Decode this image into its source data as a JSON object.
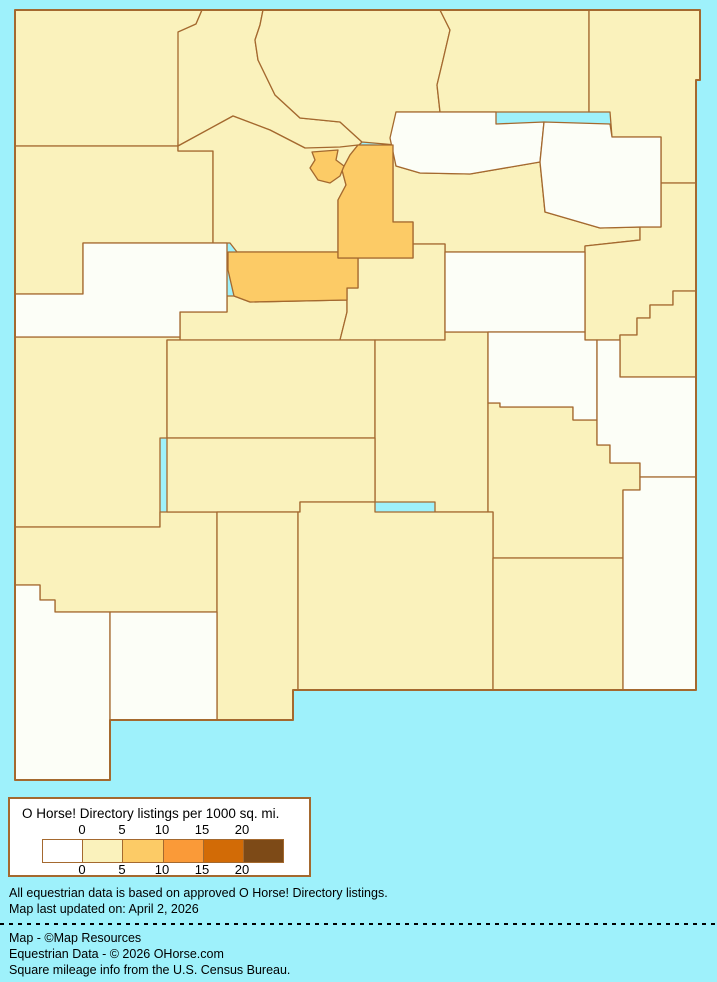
{
  "page": {
    "background_color": "#9EF1FB"
  },
  "map": {
    "description": "New Mexico county choropleth",
    "border_color": "#A4692F",
    "bucket_colors": {
      "0": "#FCFEF7",
      "0-5": "#FAF2BC",
      "5-10": "#FCCB66"
    },
    "state_outline": "15,10 700,10 700,80 696,80 696,690 293,690 293,720 110,720 110,780 15,780",
    "counties": [
      {
        "id": "san-juan",
        "bucket": "0-5",
        "points": "15,10 202,10 196,24 180,32 178,146 15,146"
      },
      {
        "id": "rio-arriba",
        "bucket": "0-5",
        "points": "202,10 263,10 260,25 255,40 258,60 275,95 300,118 340,122 362,142 356,148 338,150 312,152 305,148 270,130 233,116 178,146 178,32 196,24"
      },
      {
        "id": "taos",
        "bucket": "0-5",
        "points": "263,10 440,10 450,30 443,60 437,85 440,112 396,112 396,145 362,142 340,122 300,118 275,95 258,60 255,40 260,25"
      },
      {
        "id": "colfax",
        "bucket": "0-5",
        "points": "440,10 589,10 589,112 440,112 437,85 443,60 450,30"
      },
      {
        "id": "union",
        "bucket": "0-5",
        "points": "589,10 700,10 700,80 696,80 696,183 661,183 661,137 612,137 610,112 589,112"
      },
      {
        "id": "mckinley",
        "bucket": "0-5",
        "points": "15,146 178,146 178,151 213,151 213,243 83,243 83,294 15,294"
      },
      {
        "id": "sandoval",
        "bucket": "0-5",
        "points": "178,146 233,116 270,130 305,148 340,147 358,145 350,155 342,170 346,185 338,200 338,252 237,252 230,243 213,243 213,151 178,151"
      },
      {
        "id": "san-miguel",
        "bucket": "0-5",
        "points": "393,145 396,166 420,173 470,174 540,162 545,212 600,228 640,227 640,240 585,246 585,252 445,252 445,244 413,244 413,222 393,222"
      },
      {
        "id": "quay",
        "bucket": "0-5",
        "points": "585,246 640,240 640,227 661,227 661,183 696,183 696,291 673,291 673,305 650,305 650,318 637,318 637,335 620,335 620,340 585,340"
      },
      {
        "id": "curry",
        "bucket": "0-5",
        "points": "620,335 637,335 637,318 650,318 650,305 673,305 673,291 696,291 696,377 620,377"
      },
      {
        "id": "valencia",
        "bucket": "0-5",
        "points": "227,312 227,296 234,296 250,302 347,300 347,312 340,340 180,340 180,312"
      },
      {
        "id": "torrance",
        "bucket": "0-5",
        "points": "358,258 413,258 413,244 445,244 445,340 340,340 347,312 347,300 347,288 358,288"
      },
      {
        "id": "catron",
        "bucket": "0-5",
        "points": "15,337 180,337 180,340 167,340 167,438 160,438 160,527 15,527"
      },
      {
        "id": "socorro",
        "bucket": "0-5",
        "points": "167,340 375,340 375,438 167,438"
      },
      {
        "id": "lincoln",
        "bucket": "0-5",
        "points": "375,340 445,340 445,332 488,332 488,512 435,512 435,502 375,502"
      },
      {
        "id": "chaves",
        "bucket": "0-5",
        "points": "488,403 500,403 500,407 573,407 573,420 597,420 597,445 610,445 610,463 640,463 640,490 623,490 623,558 493,558 493,512 488,512"
      },
      {
        "id": "grant",
        "bucket": "0-5",
        "points": "15,527 160,527 160,512 217,512 217,612 55,612 55,600 40,600 40,585 15,585"
      },
      {
        "id": "sierra",
        "bucket": "0-5",
        "points": "167,438 375,438 375,502 300,502 300,512 167,512"
      },
      {
        "id": "dona-ana",
        "bucket": "0-5",
        "points": "217,512 298,512 298,690 293,690 293,720 217,720"
      },
      {
        "id": "otero",
        "bucket": "0-5",
        "points": "298,512 300,512 300,502 375,502 375,512 493,512 493,690 298,690"
      },
      {
        "id": "eddy",
        "bucket": "0-5",
        "points": "493,558 623,558 623,690 493,690"
      },
      {
        "id": "cibola",
        "bucket": "0",
        "points": "15,294 83,294 83,243 227,243 227,312 180,312 180,337 15,337"
      },
      {
        "id": "mora",
        "bucket": "0",
        "points": "396,112 496,112 496,124 544,122 540,162 470,174 420,173 396,166 390,138"
      },
      {
        "id": "harding",
        "bucket": "0",
        "points": "544,122 610,124 612,137 661,137 661,227 640,227 600,228 545,212 540,162"
      },
      {
        "id": "guadalupe",
        "bucket": "0",
        "points": "445,252 585,252 585,332 445,332"
      },
      {
        "id": "de-baca",
        "bucket": "0",
        "points": "488,332 585,332 585,340 597,340 597,420 573,420 573,407 500,407 500,403 488,403"
      },
      {
        "id": "roosevelt",
        "bucket": "0",
        "points": "597,340 620,340 620,377 696,377 696,477 640,477 640,463 610,463 610,445 597,445"
      },
      {
        "id": "lea",
        "bucket": "0",
        "points": "640,477 696,477 696,690 623,690 623,490 640,490"
      },
      {
        "id": "hidalgo",
        "bucket": "0",
        "points": "15,585 40,585 40,600 55,600 55,612 110,612 110,780 15,780"
      },
      {
        "id": "luna",
        "bucket": "0",
        "points": "110,612 217,612 217,720 110,720"
      },
      {
        "id": "bernalillo",
        "bucket": "5-10",
        "points": "228,252 338,252 338,258 358,258 358,288 347,288 347,300 250,302 234,296 228,270"
      },
      {
        "id": "santa-fe",
        "bucket": "5-10",
        "points": "358,145 393,145 393,222 413,222 413,258 338,258 338,200 346,185 342,170 350,155"
      },
      {
        "id": "los-alamos",
        "bucket": "5-10",
        "points": "312,152 338,150 336,160 344,166 340,176 330,183 318,180 310,168 315,160"
      }
    ]
  },
  "legend": {
    "title": "O Horse! Directory listings per 1000 sq. mi.",
    "border_color": "#A4692F",
    "tick_labels": [
      "0",
      "5",
      "10",
      "15",
      "20"
    ],
    "swatches": [
      {
        "range": "0",
        "color": "#FFFFFF"
      },
      {
        "range": "0-5",
        "color": "#FAF2BC"
      },
      {
        "range": "5-10",
        "color": "#FCCB66"
      },
      {
        "range": "10-15",
        "color": "#FA9A38"
      },
      {
        "range": "15-20",
        "color": "#D26B06"
      },
      {
        "range": "20+",
        "color": "#7D4A17"
      }
    ]
  },
  "notes": {
    "line1": "All equestrian data is based on approved O Horse! Directory listings.",
    "line2": "Map last updated on: April 2, 2026"
  },
  "credits": {
    "line1": "Map - ©Map Resources",
    "line2": "Equestrian Data - © 2026 OHorse.com",
    "line3": "Square mileage info from the U.S. Census Bureau."
  }
}
